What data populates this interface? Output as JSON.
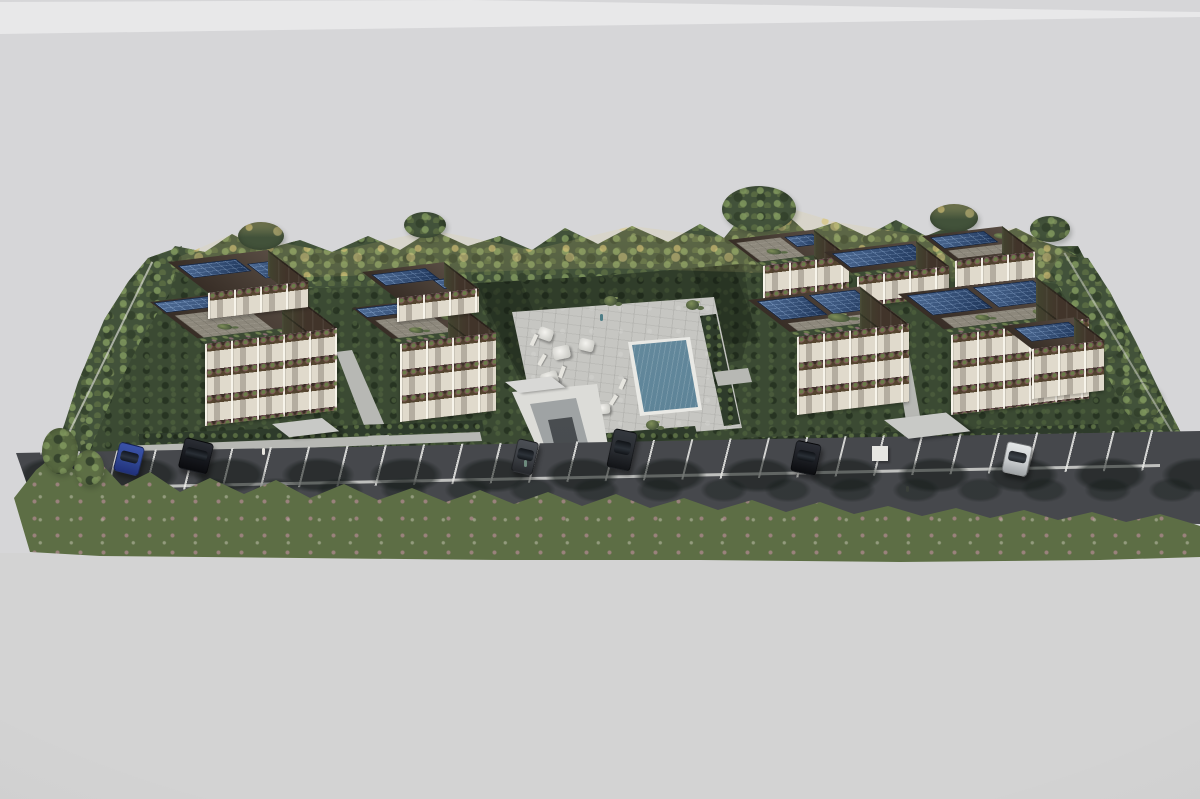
{
  "meta": {
    "kind": "architectural-aerial-rendering",
    "description": "Photoreal 3D render, elevated front view of a residential eco-complex on a neutral gray studio backdrop: six apartment buildings with rooftop photovoltaic arrays and roof gardens, central swimming pool with sun deck and umbrellas, underground-garage ramp, front parking road with marked bays and parked cars, perimeter hedges and tree rows.",
    "visible_text": []
  },
  "palette": {
    "bg": "#d6d6d8",
    "bg_top_highlight": "#ececee",
    "bg_bottom": "#d3d3d3",
    "forest_mid": "#42523a",
    "forest_gold": "#d8c183",
    "lawn": "#3b4a33",
    "front_trees": "#5d6e45",
    "asphalt": "#46484c",
    "asphalt_shadow": "#24292a",
    "parking_line": "#e6e6e2",
    "deck": "#c6c6c2",
    "pool_water": "#6f94a6",
    "pool_coping": "#e9e9e5",
    "wall_cream": "#e0dacc",
    "wall_brown": "#41342a",
    "wall_brown_dark": "#4a3d33",
    "terrace_paver": "#8d887c",
    "solar_blue": "#24406b",
    "canopy_gray": "#c8c9c6",
    "ramp_white": "#dcdcd8",
    "car_blue": "#2e4490",
    "car_black": "#15171c",
    "car_gray": "#3a3d42",
    "car_silver": "#c9ccce",
    "umbrella_white": "#f0efeb"
  },
  "scene": {
    "buildings": [
      {
        "id": "left-front",
        "floors": 3,
        "features": [
          "penthouse",
          "solar-roof",
          "roof-garden",
          "planted-balconies"
        ]
      },
      {
        "id": "left-rear",
        "floors": 3,
        "features": [
          "penthouse",
          "solar-roof",
          "roof-garden",
          "planted-balconies"
        ]
      },
      {
        "id": "right-back-a",
        "floors": 3,
        "features": [
          "roof-terrace",
          "solar-roof"
        ]
      },
      {
        "id": "right-back-b",
        "floors": 3,
        "features": [
          "solar-roof"
        ]
      },
      {
        "id": "right-back-c",
        "floors": 3,
        "features": [
          "solar-roof",
          "roof-terrace"
        ]
      },
      {
        "id": "right-front-left",
        "floors": 3,
        "features": [
          "large-solar-array",
          "roof-garden",
          "deep-balconies"
        ]
      },
      {
        "id": "right-front-right",
        "floors": 3,
        "features": [
          "two-solar-arrays",
          "side-wing-solar",
          "roof-garden"
        ]
      }
    ],
    "amenities": [
      "swimming-pool",
      "spa-tub",
      "sun-deck",
      "white-umbrellas",
      "sun-loungers",
      "garage-ramp",
      "entrance-canopies",
      "garden-lawn",
      "perimeter-hedges"
    ],
    "cars": [
      {
        "color_key": "car_blue"
      },
      {
        "color_key": "car_black"
      },
      {
        "color_key": "car_gray"
      },
      {
        "color_key": "car_black"
      },
      {
        "color_key": "car_black"
      },
      {
        "color_key": "car_silver"
      }
    ],
    "environment": [
      "back-tree-line-green-gold",
      "front-street-tree-row",
      "tree-shadows-on-asphalt",
      "parking-bay-lines"
    ]
  }
}
